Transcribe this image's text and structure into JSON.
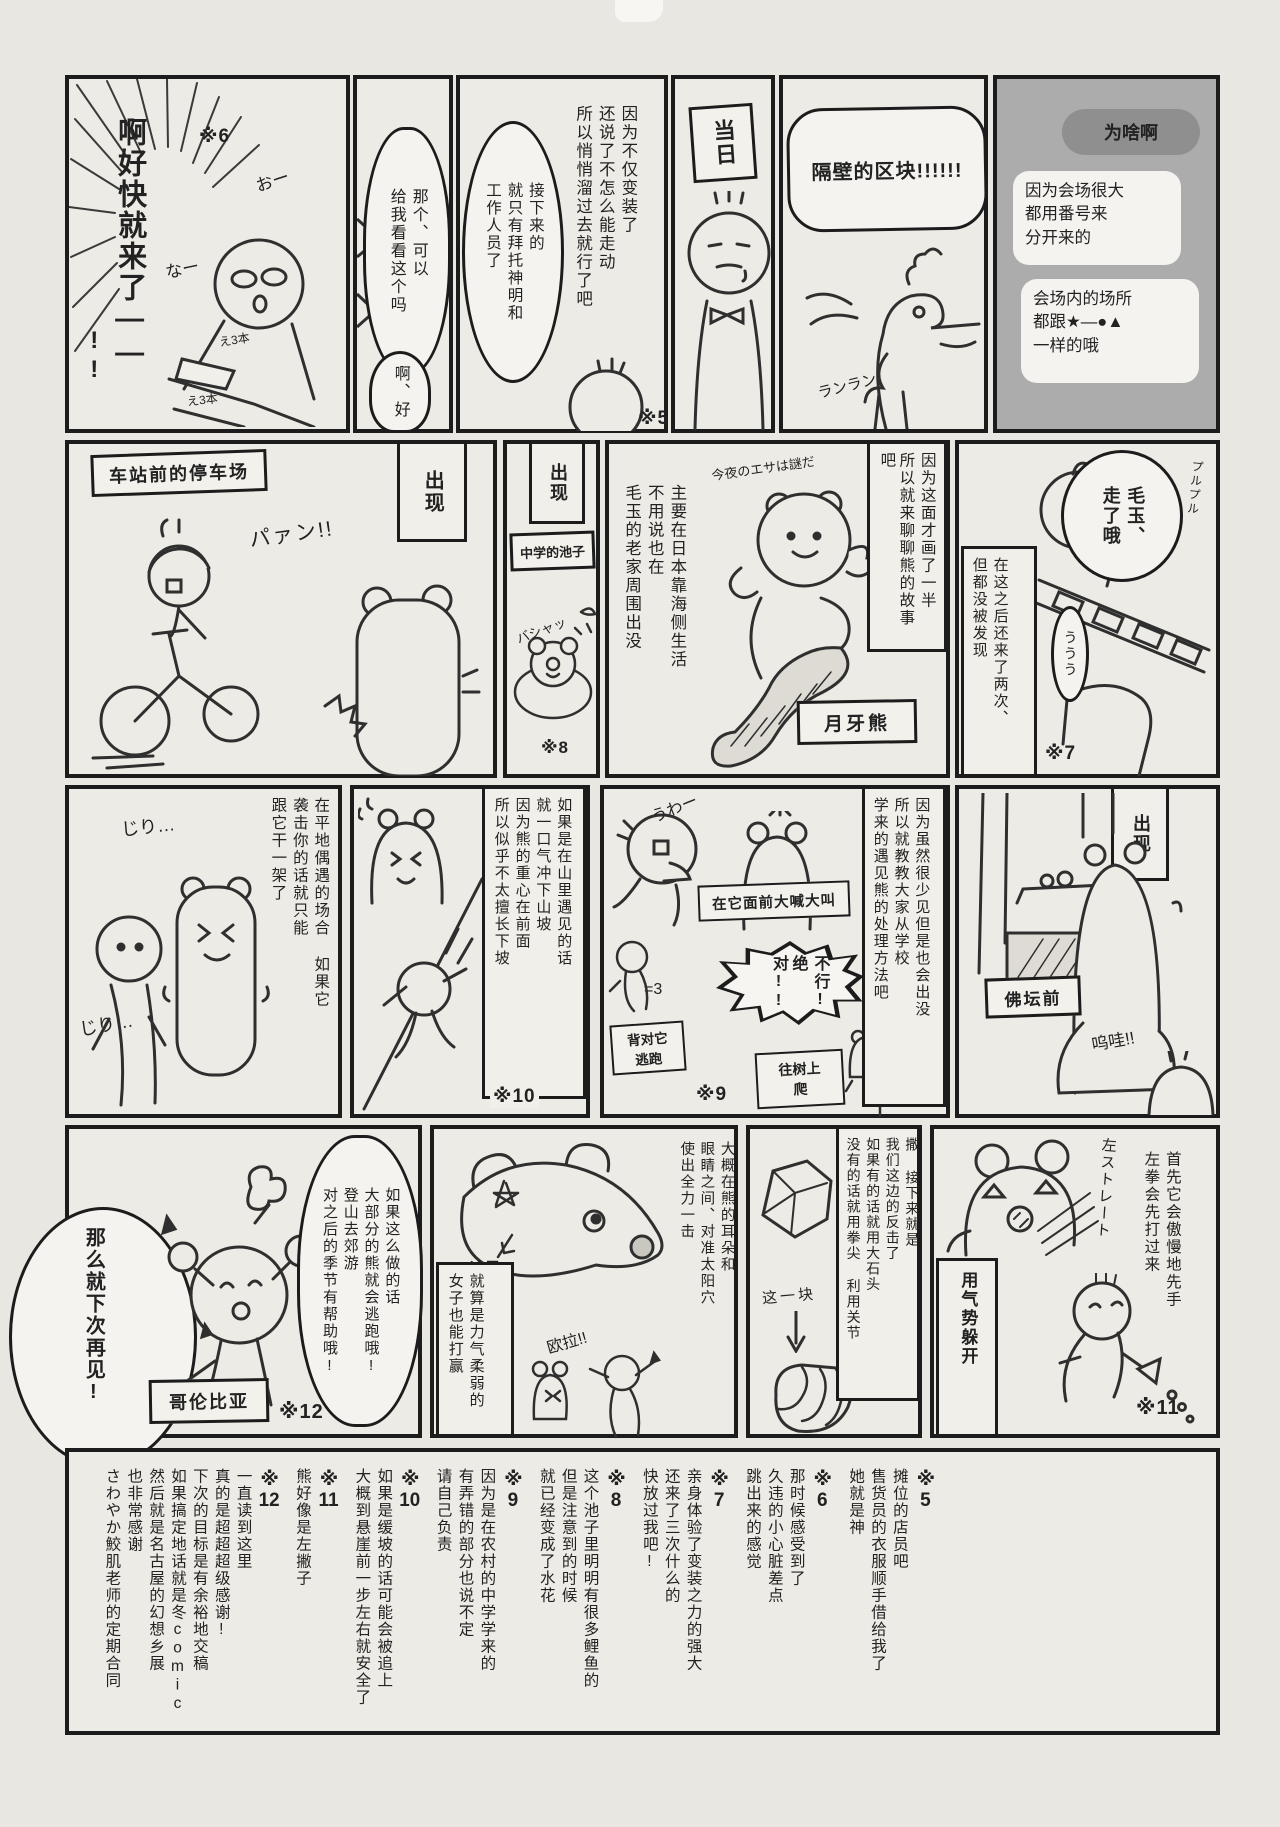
{
  "page": {
    "paper_color": "#e9e7e1",
    "ink_color": "#1c1c1c",
    "gray_panel_color": "#acacac",
    "dark_bubble_color": "#8f8f8f"
  },
  "r1p1": {
    "shout1": "啊好快就来了——",
    "shout2": "!!",
    "ref": "※6",
    "sfx_o": "おー",
    "sfx_na": "なー",
    "book": "え3本"
  },
  "r1p2": {
    "bubble": [
      "那个、可以",
      "给我看看这个吗"
    ],
    "reply": "啊、好"
  },
  "r1p3": {
    "bubble": [
      "接下来的",
      "就只有拜托神明和",
      "工作人员了"
    ],
    "caption": [
      "因为不仅变装了",
      "还说了不怎么能走动",
      "所以悄悄溜过去就行了吧"
    ],
    "ref": "※5"
  },
  "r1p4": {
    "sign": "当日"
  },
  "r1p5": {
    "title": "隔壁的区块!!!!!!",
    "sfx": "ランラン"
  },
  "r1p6": {
    "question": "为啥啊",
    "answer1": [
      "因为会场很大",
      "都用番号来",
      "分开来的"
    ],
    "answer2": [
      "会场内的场所",
      "都跟★—●▲",
      "一样的哦"
    ]
  },
  "r2p1": {
    "sign": "车站前的停车场",
    "appear": "出现",
    "sfx": "パァン!!"
  },
  "r2p2": {
    "sign": "中学的池子",
    "appear": "出现",
    "sfx": "バシャッ",
    "ref": "※8"
  },
  "r2p3": {
    "caption": [
      "主要在日本靠海侧生活",
      "不用说也在",
      "毛玉的老家周围出没"
    ],
    "note": [
      "因为这面才画了一半",
      "所以就来聊聊熊的故事吧"
    ],
    "hand": "今夜のエサは謎だ",
    "sign": "月牙熊"
  },
  "r2p4": {
    "bubble": [
      "毛玉、",
      "走了哦"
    ],
    "caption": [
      "在这之后还来了两次、",
      "但都没被发现"
    ],
    "sfx_u": "ううう",
    "sfx_p": "プルプル",
    "ref": "※7"
  },
  "r3p1": {
    "caption": [
      "在平地偶遇的场合 如果它",
      "袭击你的话就只能",
      "跟它干一架了"
    ],
    "sfx1": "じり…",
    "sfx2": "じり…"
  },
  "r3p2": {
    "caption": [
      "如果是在山里遇见的话",
      "就一口气冲下山坡",
      "因为熊的重心在前面",
      "所以似乎不太擅长下坡"
    ],
    "ref": "※10"
  },
  "r3p3": {
    "caption": [
      "因为虽然很少见但是也会出没",
      "所以就教教大家从学校",
      "学来的遇见熊的处理方法吧"
    ],
    "shout_box": "在它面前大喊大叫",
    "burst": [
      "不行!",
      "绝对!!"
    ],
    "run_box": [
      "背对它",
      "逃跑"
    ],
    "tree_box": [
      "往树上",
      "爬"
    ],
    "sfx_uwa": "うわー",
    "sfx_dash": "=3",
    "ref": "※9"
  },
  "r3p4": {
    "appear": "出现",
    "sign": "佛坛前",
    "sfx": "呜哇!!"
  },
  "r4p1": {
    "farewell": "那么就下次再见!",
    "bubble": [
      "如果这么做的话",
      "大部分的熊就会逃跑哦!",
      "登山去郊游",
      "对之后的季节有帮助哦!"
    ],
    "sign": "哥伦比亚",
    "ref": "※12"
  },
  "r4p2": {
    "here": "这里",
    "box": [
      "就算是力气柔弱的",
      "女子也能打赢"
    ],
    "caption": [
      "大概在熊的耳朵和",
      "眼睛之间、对准太阳穴",
      "使出全力一击"
    ],
    "sfx": "欧拉!!"
  },
  "r4p3": {
    "caption": [
      "撒 接下来就是",
      "我们这边的反击了",
      "如果有的话就用大石头",
      "没有的话就用拳尖 利用关节"
    ],
    "piece": "这一块"
  },
  "r4p4": {
    "caption": [
      "首先它会傲慢地先手",
      "左拳会先打过来"
    ],
    "hand": "左ストレート",
    "dodge": "用气势躲开",
    "ref": "※11"
  },
  "footnotes": [
    {
      "mark": "※",
      "num": "5",
      "lines": [
        "摊位的店员吧",
        "售货员的衣服顺手借给我了",
        "她就是神"
      ]
    },
    {
      "mark": "※",
      "num": "6",
      "lines": [
        "那时候感受到了",
        "久违的小心脏差点",
        "跳出来的感觉"
      ]
    },
    {
      "mark": "※",
      "num": "7",
      "lines": [
        "亲身体验了变装之力的强大",
        "还来了三次什么的",
        "快放过我吧!"
      ]
    },
    {
      "mark": "※",
      "num": "8",
      "lines": [
        "这个池子里明明有很多鲤鱼的",
        "但是注意到的时候",
        "就已经变成了水花"
      ]
    },
    {
      "mark": "※",
      "num": "9",
      "lines": [
        "因为是在农村的中学学来的",
        "有弄错的部分也说不定",
        "请自己负责"
      ]
    },
    {
      "mark": "※",
      "num": "10",
      "lines": [
        "如果是缓坡的话可能会被追上",
        "大概到悬崖前一步左右就安全了"
      ]
    },
    {
      "mark": "※",
      "num": "11",
      "lines": [
        "熊好像是左撇子"
      ]
    },
    {
      "mark": "※",
      "num": "12",
      "lines": [
        "一直读到这里",
        "真的是超超超级感谢!",
        "下次的目标是有余裕地交稿",
        "如果搞定地话就是冬comic",
        "然后就是名古屋的幻想乡展",
        "也非常感谢",
        "さわやか鮫肌老师的定期合同"
      ]
    }
  ]
}
